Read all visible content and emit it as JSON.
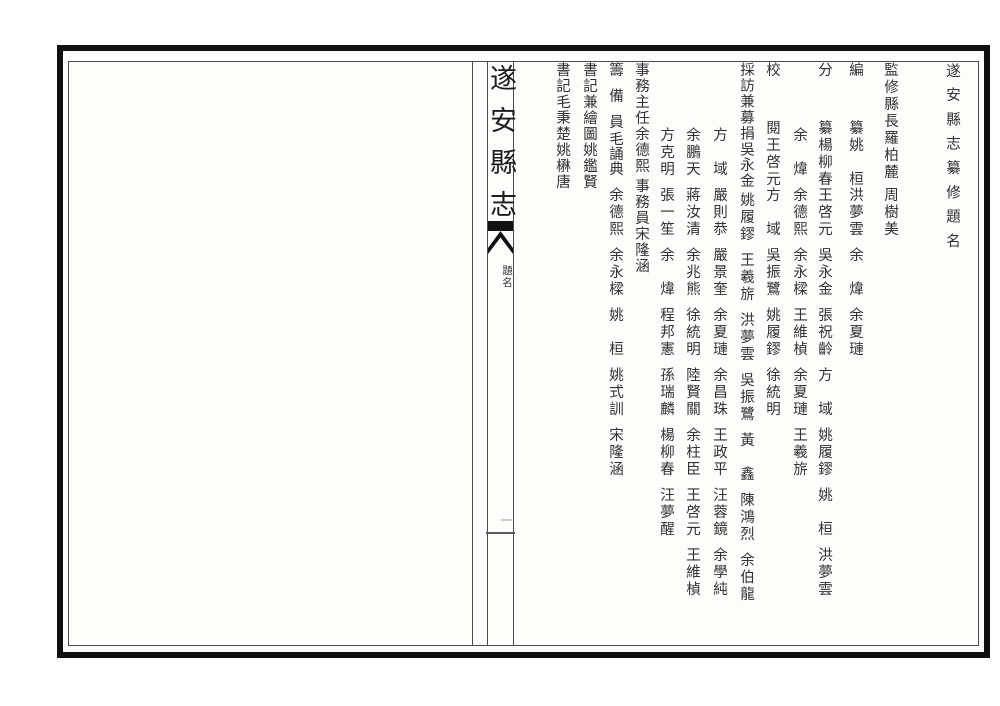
{
  "page": {
    "book_title": "遂安縣志",
    "spine_section_label": "題名",
    "spine_page_number": "一"
  },
  "roster": {
    "title": "遂安縣志纂修題名",
    "sections": [
      {
        "role": "監修縣長",
        "members": [
          "羅柏麓",
          "周樹美"
        ]
      },
      {
        "role": "編纂",
        "members": [
          "姚桓",
          "洪夢雲",
          "余煒",
          "余夏璉"
        ]
      },
      {
        "role": "分纂",
        "members": [
          "楊柳春",
          "王啓元",
          "吳永金",
          "張祝齡",
          "方域",
          "姚履鏐",
          "姚桓",
          "洪夢雲",
          "余煒",
          "余德熙",
          "余永樑",
          "王維楨",
          "余夏璉",
          "王羲旂"
        ]
      },
      {
        "role": "校閱",
        "members": [
          "王啓元",
          "方域",
          "吳振鷺",
          "姚履鏐",
          "徐統明"
        ]
      },
      {
        "role": "採訪兼募捐",
        "members": [
          "吳永金",
          "姚履鏐",
          "王羲旂",
          "洪夢雲",
          "吳振鷺",
          "黃鑫",
          "陳鴻烈",
          "余伯龍",
          "方域",
          "嚴則恭",
          "嚴景奎",
          "余夏璉",
          "余昌珠",
          "王政平",
          "汪蓉鏡",
          "余學純",
          "余鵬天",
          "蔣汝清",
          "余兆熊",
          "徐統明",
          "陸賢關",
          "余柱臣",
          "王啓元",
          "王維楨",
          "方克明",
          "張一笙",
          "余煒",
          "程邦憲",
          "孫瑞麟",
          "楊柳春",
          "汪夢醒"
        ]
      },
      {
        "role": "事務主任",
        "members": [
          "余德熙"
        ]
      },
      {
        "role": "事務員",
        "members": [
          "宋隆涵"
        ]
      },
      {
        "role": "籌備員",
        "members": [
          "毛誦典",
          "余德熙",
          "余永樑",
          "姚桓",
          "姚式訓",
          "宋隆涵"
        ]
      },
      {
        "role": "書記兼繪圖",
        "members": [
          "姚鑑賢"
        ]
      },
      {
        "role": "書記",
        "members": [
          "毛秉楚",
          "姚楙唐"
        ]
      }
    ]
  }
}
